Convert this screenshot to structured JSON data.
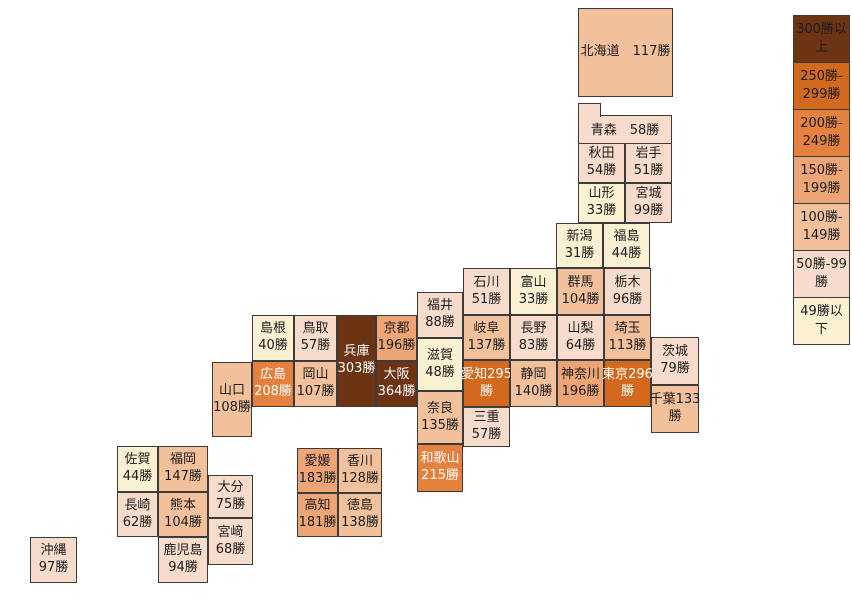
{
  "legend": {
    "items": [
      {
        "line1": "300勝以",
        "line2": "上",
        "label": "300勝以上",
        "color": "#6D3414"
      },
      {
        "line1": "250勝-",
        "line2": "299勝",
        "label": "250勝-299勝",
        "color": "#D2691E"
      },
      {
        "line1": "200勝-",
        "line2": "249勝",
        "label": "200勝-249勝",
        "color": "#E5813E"
      },
      {
        "line1": "150勝-",
        "line2": "199勝",
        "label": "150勝-199勝",
        "color": "#EEA576"
      },
      {
        "line1": "100勝-",
        "line2": "149勝",
        "label": "100勝-149勝",
        "color": "#F2C09B"
      },
      {
        "line1": "50勝-99",
        "line2": "勝",
        "label": "50勝-99勝",
        "color": "#F7DCCB"
      },
      {
        "line1": "49勝以",
        "line2": "下",
        "label": "49勝以下",
        "color": "#FAF0D2"
      }
    ]
  },
  "map": {
    "prefectures": [
      {
        "name": "北海道",
        "value": 117,
        "l1": "北海道　117勝",
        "l2": ""
      },
      {
        "name": "青森",
        "value": 58,
        "l1": "青森　58勝",
        "l2": ""
      },
      {
        "name": "秋田",
        "value": 54,
        "l1": "秋田",
        "l2": "54勝"
      },
      {
        "name": "岩手",
        "value": 51,
        "l1": "岩手",
        "l2": "51勝"
      },
      {
        "name": "山形",
        "value": 33,
        "l1": "山形",
        "l2": "33勝"
      },
      {
        "name": "宮城",
        "value": 99,
        "l1": "宮城",
        "l2": "99勝"
      },
      {
        "name": "新潟",
        "value": 31,
        "l1": "新潟",
        "l2": "31勝"
      },
      {
        "name": "福島",
        "value": 44,
        "l1": "福島",
        "l2": "44勝"
      },
      {
        "name": "石川",
        "value": 51,
        "l1": "石川",
        "l2": "51勝"
      },
      {
        "name": "富山",
        "value": 33,
        "l1": "富山",
        "l2": "33勝"
      },
      {
        "name": "群馬",
        "value": 104,
        "l1": "群馬",
        "l2": "104勝"
      },
      {
        "name": "栃木",
        "value": 96,
        "l1": "栃木",
        "l2": "96勝"
      },
      {
        "name": "福井",
        "value": 88,
        "l1": "福井",
        "l2": "88勝"
      },
      {
        "name": "岐阜",
        "value": 137,
        "l1": "岐阜",
        "l2": "137勝"
      },
      {
        "name": "長野",
        "value": 83,
        "l1": "長野",
        "l2": "83勝"
      },
      {
        "name": "山梨",
        "value": 64,
        "l1": "山梨",
        "l2": "64勝"
      },
      {
        "name": "埼玉",
        "value": 113,
        "l1": "埼玉",
        "l2": "113勝"
      },
      {
        "name": "茨城",
        "value": 79,
        "l1": "茨城",
        "l2": "79勝"
      },
      {
        "name": "滋賀",
        "value": 48,
        "l1": "滋賀",
        "l2": "48勝"
      },
      {
        "name": "愛知",
        "value": 295,
        "l1": "愛知295",
        "l2": "勝"
      },
      {
        "name": "静岡",
        "value": 140,
        "l1": "静岡",
        "l2": "140勝"
      },
      {
        "name": "神奈川",
        "value": 196,
        "l1": "神奈川",
        "l2": "196勝"
      },
      {
        "name": "東京",
        "value": 296,
        "l1": "東京296",
        "l2": "勝"
      },
      {
        "name": "千葉",
        "value": 133,
        "l1": "千葉133",
        "l2": "勝"
      },
      {
        "name": "奈良",
        "value": 135,
        "l1": "奈良",
        "l2": "135勝"
      },
      {
        "name": "三重",
        "value": 57,
        "l1": "三重",
        "l2": "57勝"
      },
      {
        "name": "和歌山",
        "value": 215,
        "l1": "和歌山",
        "l2": "215勝"
      },
      {
        "name": "京都",
        "value": 196,
        "l1": "京都",
        "l2": "196勝"
      },
      {
        "name": "大阪",
        "value": 364,
        "l1": "大阪",
        "l2": "364勝"
      },
      {
        "name": "兵庫",
        "value": 303,
        "l1": "兵庫",
        "l2": "303勝"
      },
      {
        "name": "鳥取",
        "value": 57,
        "l1": "鳥取",
        "l2": "57勝"
      },
      {
        "name": "島根",
        "value": 40,
        "l1": "島根",
        "l2": "40勝"
      },
      {
        "name": "岡山",
        "value": 107,
        "l1": "岡山",
        "l2": "107勝"
      },
      {
        "name": "広島",
        "value": 208,
        "l1": "広島",
        "l2": "208勝"
      },
      {
        "name": "山口",
        "value": 108,
        "l1": "山口",
        "l2": "108勝"
      },
      {
        "name": "愛媛",
        "value": 183,
        "l1": "愛媛",
        "l2": "183勝"
      },
      {
        "name": "香川",
        "value": 128,
        "l1": "香川",
        "l2": "128勝"
      },
      {
        "name": "高知",
        "value": 181,
        "l1": "高知",
        "l2": "181勝"
      },
      {
        "name": "徳島",
        "value": 138,
        "l1": "徳島",
        "l2": "138勝"
      },
      {
        "name": "佐賀",
        "value": 44,
        "l1": "佐賀",
        "l2": "44勝"
      },
      {
        "name": "福岡",
        "value": 147,
        "l1": "福岡",
        "l2": "147勝"
      },
      {
        "name": "長崎",
        "value": 62,
        "l1": "長崎",
        "l2": "62勝"
      },
      {
        "name": "熊本",
        "value": 104,
        "l1": "熊本",
        "l2": "104勝"
      },
      {
        "name": "大分",
        "value": 75,
        "l1": "大分",
        "l2": "75勝"
      },
      {
        "name": "宮﨑",
        "value": 68,
        "l1": "宮﨑",
        "l2": "68勝"
      },
      {
        "name": "鹿児島",
        "value": 94,
        "l1": "鹿児島",
        "l2": "94勝"
      },
      {
        "name": "沖縄",
        "value": 97,
        "l1": "沖縄",
        "l2": "97勝"
      }
    ]
  },
  "chart_data": {
    "type": "heatmap",
    "subtype": "japan-prefecture-tile-map",
    "title": "",
    "unit": "勝",
    "legend_position": "right",
    "bins": [
      {
        "label": "300勝以上",
        "color": "#6D3414"
      },
      {
        "label": "250勝-299勝",
        "color": "#D2691E"
      },
      {
        "label": "200勝-249勝",
        "color": "#E5813E"
      },
      {
        "label": "150勝-199勝",
        "color": "#EEA576"
      },
      {
        "label": "100勝-149勝",
        "color": "#F2C09B"
      },
      {
        "label": "50勝-99勝",
        "color": "#F7DCCB"
      },
      {
        "label": "49勝以下",
        "color": "#FAF0D2"
      }
    ],
    "categories": [
      "北海道",
      "青森",
      "秋田",
      "岩手",
      "山形",
      "宮城",
      "新潟",
      "福島",
      "石川",
      "富山",
      "群馬",
      "栃木",
      "福井",
      "岐阜",
      "長野",
      "山梨",
      "埼玉",
      "茨城",
      "滋賀",
      "愛知",
      "静岡",
      "神奈川",
      "東京",
      "千葉",
      "奈良",
      "三重",
      "和歌山",
      "京都",
      "大阪",
      "兵庫",
      "鳥取",
      "島根",
      "岡山",
      "広島",
      "山口",
      "愛媛",
      "香川",
      "高知",
      "徳島",
      "佐賀",
      "福岡",
      "長崎",
      "熊本",
      "大分",
      "宮﨑",
      "鹿児島",
      "沖縄"
    ],
    "values": [
      117,
      58,
      54,
      51,
      33,
      99,
      31,
      44,
      51,
      33,
      104,
      96,
      88,
      137,
      83,
      64,
      113,
      79,
      48,
      295,
      140,
      196,
      296,
      133,
      135,
      57,
      215,
      196,
      364,
      303,
      57,
      40,
      107,
      208,
      108,
      183,
      128,
      181,
      138,
      44,
      147,
      62,
      104,
      75,
      68,
      94,
      97
    ]
  }
}
